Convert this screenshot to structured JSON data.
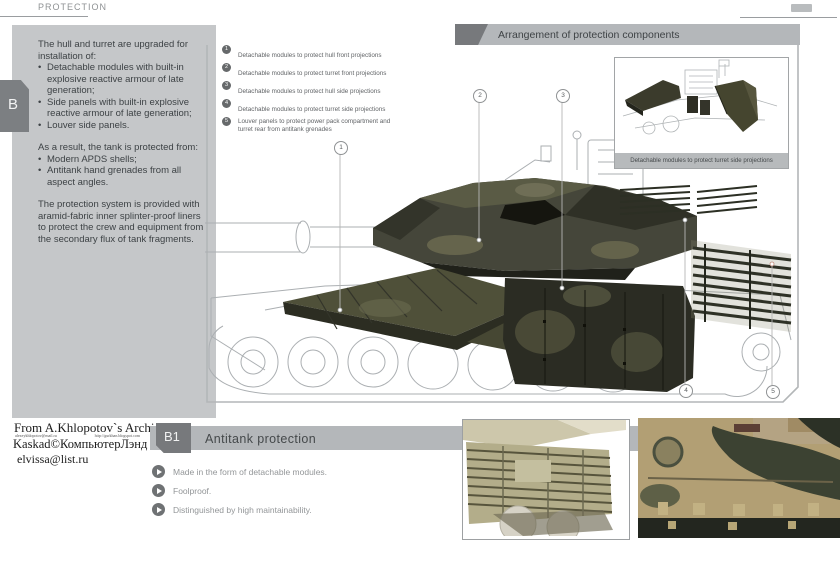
{
  "page_header": {
    "title": "PROTECTION"
  },
  "side_tab": {
    "label": "B"
  },
  "info_panel": {
    "para1_intro": "The hull and turret are upgraded for installation of:",
    "para1_bullets": [
      "Detachable modules with built-in explosive reactive armour of late generation;",
      "Side panels with built-in explosive reactive armour of late generation;",
      "Louver side panels."
    ],
    "para2_intro": "As a result, the tank is protected from:",
    "para2_bullets": [
      "Modern APDS shells;",
      "Antitank hand grenades from all aspect angles."
    ],
    "para3": "The protection system is provided with aramid-fabric inner splinter-proof liners to protect the crew and equipment from the secondary flux of tank fragments."
  },
  "diagram": {
    "title": "Arrangement of protection components",
    "legend": [
      {
        "num": "1",
        "text": "Detachable modules to protect hull front projections"
      },
      {
        "num": "2",
        "text": "Detachable modules to protect turret front projections"
      },
      {
        "num": "3",
        "text": "Detachable modules to protect hull side projections"
      },
      {
        "num": "4",
        "text": "Detachable modules to protect turret side projections"
      },
      {
        "num": "5",
        "text": "Louver panels to protect power pack compartment and turret rear from antitank grenades"
      }
    ],
    "callouts": [
      {
        "num": "1"
      },
      {
        "num": "2"
      },
      {
        "num": "3"
      },
      {
        "num": "4"
      },
      {
        "num": "5"
      }
    ],
    "inset_caption": "Detachable modules to protect turret side projections"
  },
  "archive": {
    "line1": "From A.Khlopotov`s Archive",
    "small_left": "alexeykhlopotov@mail.ru",
    "small_right": "http://gurkhan.blogspot.com",
    "line2": "Kaskad©КомпьютерЛэнд",
    "line3": "elvissa@list.ru"
  },
  "section_b1": {
    "tab": "B1",
    "title": "Antitank protection",
    "bullets": [
      "Made in the form of detachable modules.",
      "Foolproof.",
      "Distinguished by high maintainability."
    ]
  },
  "colors": {
    "armor_dark": "#2b2c23",
    "armor_mid": "#45463a",
    "panel_gray": "#c5c7c9",
    "bar_gray": "#b4b7ba",
    "accent_dark": "#77797c"
  }
}
